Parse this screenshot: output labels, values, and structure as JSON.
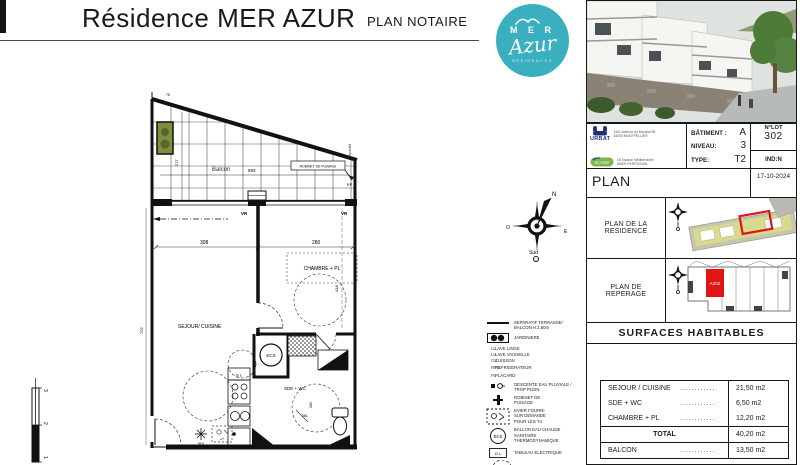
{
  "header": {
    "title": "Résidence MER AZUR",
    "subtitle": "PLAN NOTAIRE",
    "logo": {
      "mer": "M E R",
      "azur": "Azur",
      "residences": "RESIDENCES"
    }
  },
  "panel": {
    "developers": {
      "urbat_name": "URBAT",
      "urbat_addr1": "1401 Avenue du Mondial 98",
      "urbat_addr2": "34000 MONTPELLIER",
      "icade_name": "ICADE",
      "icade_addr1": "16 Espace Méditerranée",
      "icade_addr2": "66000 PERPIGNAN"
    },
    "building": {
      "batiment_label": "BÂTIMENT :",
      "batiment_value": "A",
      "niveau_label": "NIVEAU:",
      "niveau_value": "3",
      "type_label": "TYPE:",
      "type_value": "T2",
      "lot_label": "N°LOT",
      "lot_value": "302",
      "ind": "IND:N"
    },
    "plan_row": {
      "label": "PLAN",
      "date": "17-10-2024"
    },
    "residence_row": {
      "label": "PLAN DE LA RESIDENCE"
    },
    "reperage_row": {
      "label": "PLAN DE REPERAGE",
      "unit": "A302"
    },
    "surfaces": {
      "title": "SURFACES HABITABLES",
      "rows": [
        {
          "label": "SEJOUR / CUISINE",
          "dots": "............",
          "value": "21,50 m2"
        },
        {
          "label": "SDE + WC",
          "dots": "............",
          "value": "6,50 m2"
        },
        {
          "label": "CHAMBRE + PL",
          "dots": "............",
          "value": "12,20 m2"
        }
      ],
      "total_label": "TOTAL",
      "total_value": "40,20 m2",
      "balcon_label": "BALCON",
      "balcon_dots": "............",
      "balcon_value": "13,50 m2"
    }
  },
  "floorplan": {
    "rooms": {
      "balcon": "Balcon",
      "sejour": "SEJOUR/ CUISINE",
      "chambre": "CHAMBRE + PL",
      "sde": "SDE + WC"
    },
    "labels": {
      "robinet": "ROBINET DE PUISAGE",
      "ep": "EP",
      "separatif": "Séparatif",
      "vr": "VR",
      "ecs": "ECS",
      "gl": "G.L",
      "rfg": "RFG"
    },
    "dims": {
      "d78": "78",
      "d277": "277",
      "d593": "593",
      "d308": "308",
      "d280a": "280",
      "d418": "418",
      "d702": "702",
      "d280b": "280",
      "d281": "281"
    },
    "scale": {
      "s1": "1",
      "s2": "2",
      "s3": "3"
    }
  },
  "compass": {
    "n": "N",
    "e": "E",
    "o": "O",
    "s": "Sud"
  },
  "legend": {
    "separatif": {
      "l1": "SEPARATIF TERRASSE/",
      "l2": "BALCON H:1,60m"
    },
    "jardiniere": "JARDINIERE",
    "abbrevs": [
      {
        "abbr": "LL",
        "label": "LAVE LINGE"
      },
      {
        "abbr": "LV",
        "label": "LAVE VAISSELLE"
      },
      {
        "abbr": "CU",
        "label": "CUISSON"
      },
      {
        "abbr": "RFG",
        "label": "REFRIGERATEUR"
      },
      {
        "abbr": "PL",
        "label": "PLACARD"
      }
    ],
    "descente": {
      "l1": "DESCENTE EAU PLUVIALE /",
      "l2": "TROP PLEIN"
    },
    "robinet": {
      "l1": "ROBINET DE",
      "l2": "PUISAGE"
    },
    "evier": {
      "l1": "EVIER FOURNI",
      "l2": "SUR DEMANDE",
      "l3": "POUR LES T4"
    },
    "ballon": {
      "l1": "BALLON EAU CHAUDE",
      "l2": "SANITAIRE",
      "l3": "THERMODYNAMIQUE"
    },
    "ballon_symbol": "ECS",
    "tableau": "TABLEAU ELECTRIQUE",
    "tableau_symbol": "G.L"
  }
}
